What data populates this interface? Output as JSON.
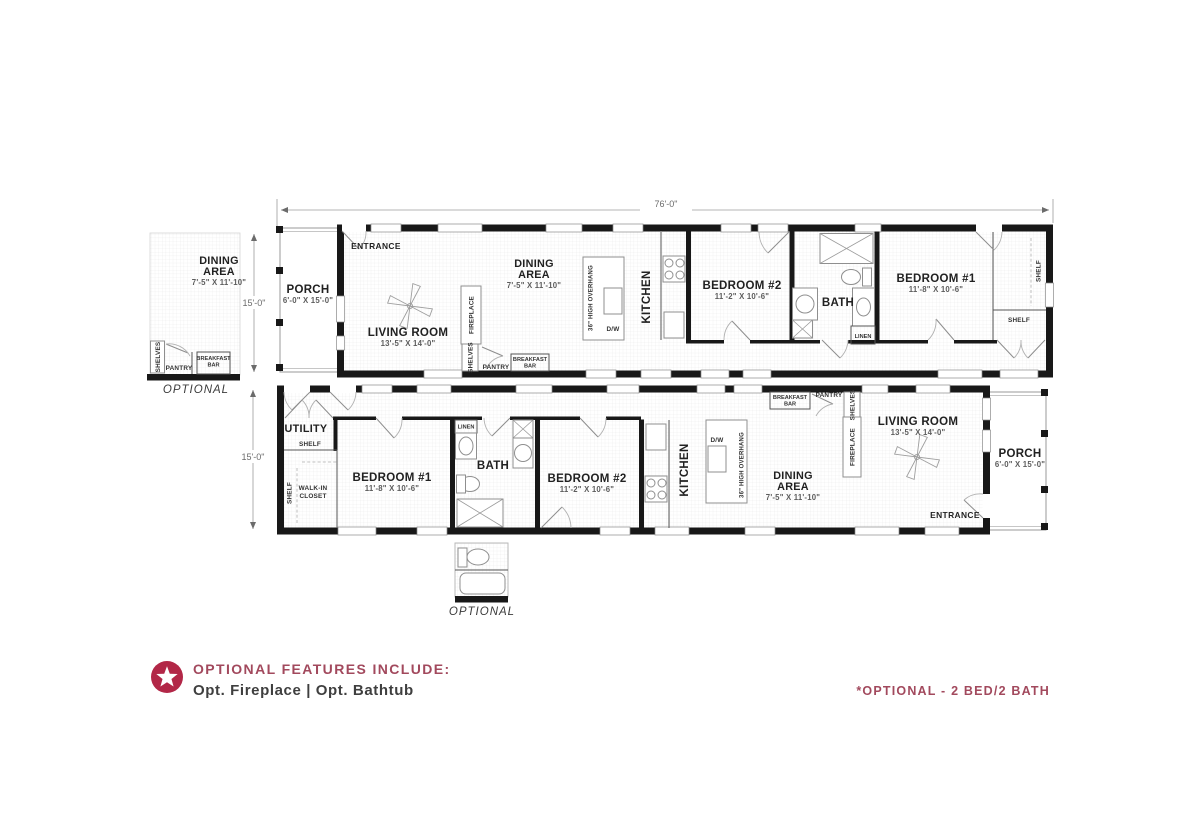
{
  "page": {
    "bg": "#ffffff",
    "accent": "#a2495d",
    "star": "#b22747"
  },
  "dimensions": {
    "overall": "76'-0\"",
    "left_top": "15'-0\"",
    "left_bottom": "15'-0\""
  },
  "labels": {
    "entrance": "ENTRANCE",
    "porch": "PORCH",
    "porch_size": "6'-0\" X 15'-0\"",
    "living": "LIVING ROOM",
    "living_size": "13'-5\" X 14'-0\"",
    "dining1": "DINING",
    "dining2": "AREA",
    "dining_size": "7'-5\" X 11'-10\"",
    "kitchen": "KITCHEN",
    "overhang": "36\" HIGH OVERHANG",
    "dw": "D/W",
    "bed1": "BEDROOM #1",
    "bed1_size": "11'-8\" X 10'-6\"",
    "bed2": "BEDROOM #2",
    "bed2_size": "11'-2\" X 10'-6\"",
    "bath": "BATH",
    "utility": "UTILITY",
    "walkin1": "WALK-IN",
    "walkin2": "CLOSET",
    "fireplace": "FIREPLACE",
    "pantry": "PANTRY",
    "shelves": "SHELVES",
    "shelf": "SHELF",
    "linen": "LINEN",
    "breakfast1": "BREAKFAST",
    "breakfast2": "BAR",
    "optional": "OPTIONAL"
  },
  "footer": {
    "title": "OPTIONAL FEATURES INCLUDE:",
    "body": "Opt. Fireplace | Opt. Bathtub",
    "note": "*OPTIONAL - 2 BED/2 BATH"
  }
}
